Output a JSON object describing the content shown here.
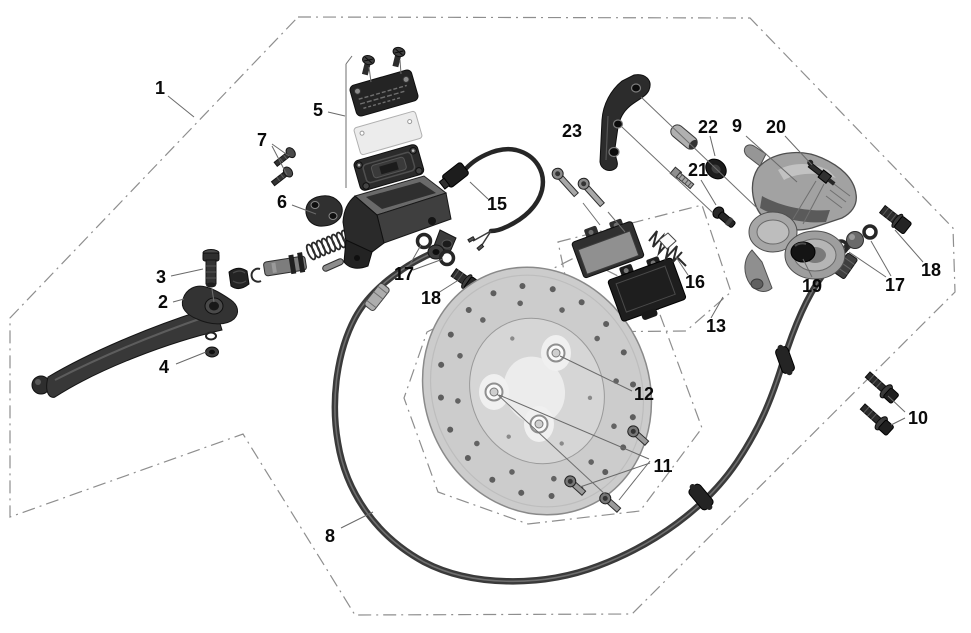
{
  "page": {
    "width": 971,
    "height": 633,
    "background": "#ffffff"
  },
  "diagram": {
    "type": "exploded-parts-diagram",
    "subject": "hydraulic-disc-brake-assembly",
    "colors": {
      "boundary_line": "#8e8e8e",
      "leader_line": "#6a6a6a",
      "label_text": "#0a0a0a",
      "dark_part": "#2b2b2b",
      "light_part": "#c9c9c9",
      "caliper_gray": "#9e9e9e",
      "disc_gray": "#cccccc",
      "background": "#ffffff"
    },
    "boundaries": [
      {
        "name": "outer-region",
        "points": [
          [
            298,
            17
          ],
          [
            750,
            18
          ],
          [
            953,
            228
          ],
          [
            955,
            292
          ],
          [
            632,
            614
          ],
          [
            355,
            615
          ],
          [
            243,
            434
          ],
          [
            10,
            517
          ],
          [
            10,
            318
          ]
        ]
      },
      {
        "name": "disc-region",
        "points": [
          [
            427,
            332
          ],
          [
            578,
            256
          ],
          [
            652,
            293
          ],
          [
            702,
            428
          ],
          [
            640,
            511
          ],
          [
            528,
            524
          ],
          [
            438,
            492
          ],
          [
            404,
            398
          ]
        ]
      },
      {
        "name": "pads-region",
        "points": [
          [
            558,
            242
          ],
          [
            702,
            205
          ],
          [
            731,
            292
          ],
          [
            686,
            331
          ],
          [
            577,
            332
          ]
        ]
      }
    ],
    "assembly_lines": [
      [
        352,
        56,
        346,
        64
      ],
      [
        346,
        64,
        346,
        188
      ],
      [
        369,
        67,
        371,
        82
      ],
      [
        400,
        60,
        401,
        74
      ],
      [
        212,
        289,
        214,
        302
      ],
      [
        641,
        97,
        757,
        208
      ],
      [
        622,
        127,
        713,
        213
      ],
      [
        583,
        203,
        600,
        225
      ],
      [
        608,
        212,
        625,
        232
      ],
      [
        816,
        181,
        793,
        219
      ],
      [
        824,
        184,
        803,
        224
      ],
      [
        497,
        394,
        607,
        496
      ]
    ],
    "callouts": [
      {
        "id": "1",
        "text": "1",
        "x": 160,
        "y": 88,
        "leaders": [
          [
            168,
            96,
            194,
            117
          ]
        ]
      },
      {
        "id": "2",
        "text": "2",
        "x": 163,
        "y": 302,
        "leaders": [
          [
            173,
            302,
            184,
            299
          ]
        ]
      },
      {
        "id": "3",
        "text": "3",
        "x": 161,
        "y": 277,
        "leaders": [
          [
            171,
            276,
            203,
            269
          ]
        ]
      },
      {
        "id": "4",
        "text": "4",
        "x": 164,
        "y": 367,
        "leaders": [
          [
            176,
            364,
            206,
            352
          ]
        ]
      },
      {
        "id": "5",
        "text": "5",
        "x": 318,
        "y": 110,
        "leaders": [
          [
            328,
            112,
            345,
            116
          ]
        ]
      },
      {
        "id": "6",
        "text": "6",
        "x": 282,
        "y": 202,
        "leaders": [
          [
            292,
            205,
            316,
            214
          ]
        ]
      },
      {
        "id": "7",
        "text": "7",
        "x": 262,
        "y": 140,
        "leaders": [
          [
            272,
            144,
            289,
            156
          ],
          [
            272,
            146,
            287,
            175
          ]
        ]
      },
      {
        "id": "8",
        "text": "8",
        "x": 330,
        "y": 536,
        "leaders": [
          [
            341,
            528,
            373,
            512
          ]
        ]
      },
      {
        "id": "9",
        "text": "9",
        "x": 737,
        "y": 126,
        "leaders": [
          [
            746,
            136,
            797,
            182
          ]
        ]
      },
      {
        "id": "10",
        "text": "10",
        "x": 918,
        "y": 418,
        "leaders": [
          [
            905,
            412,
            888,
            396
          ],
          [
            905,
            418,
            891,
            425
          ]
        ]
      },
      {
        "id": "11",
        "text": "11",
        "x": 663,
        "y": 466,
        "leaders": [
          [
            650,
            461,
            619,
            500
          ],
          [
            650,
            463,
            580,
            487
          ],
          [
            649,
            459,
            499,
            395
          ]
        ]
      },
      {
        "id": "12",
        "text": "12",
        "x": 644,
        "y": 394,
        "leaders": [
          [
            632,
            391,
            560,
            356
          ]
        ]
      },
      {
        "id": "13",
        "text": "13",
        "x": 716,
        "y": 326,
        "leaders": [
          [
            711,
            318,
            723,
            297
          ]
        ]
      },
      {
        "id": "15",
        "text": "15",
        "x": 497,
        "y": 204,
        "leaders": [
          [
            488,
            199,
            470,
            182
          ]
        ]
      },
      {
        "id": "16",
        "text": "16",
        "x": 695,
        "y": 282,
        "leaders": [
          [
            688,
            275,
            676,
            257
          ]
        ]
      },
      {
        "id": "17a",
        "text": "17",
        "x": 404,
        "y": 274,
        "leaders": [
          [
            409,
            266,
            421,
            245
          ],
          [
            413,
            270,
            443,
            259
          ]
        ]
      },
      {
        "id": "18a",
        "text": "18",
        "x": 431,
        "y": 298,
        "leaders": [
          [
            438,
            293,
            457,
            281
          ]
        ]
      },
      {
        "id": "17b",
        "text": "17",
        "x": 895,
        "y": 285,
        "leaders": [
          [
            886,
            277,
            849,
            252
          ],
          [
            891,
            276,
            871,
            241
          ]
        ]
      },
      {
        "id": "18b",
        "text": "18",
        "x": 931,
        "y": 270,
        "leaders": [
          [
            923,
            262,
            895,
            230
          ]
        ]
      },
      {
        "id": "19",
        "text": "19",
        "x": 812,
        "y": 286,
        "leaders": [
          [
            812,
            277,
            803,
            259
          ]
        ]
      },
      {
        "id": "20",
        "text": "20",
        "x": 776,
        "y": 127,
        "leaders": [
          [
            785,
            136,
            812,
            165
          ]
        ]
      },
      {
        "id": "21",
        "text": "21",
        "x": 698,
        "y": 170,
        "leaders": [
          [
            701,
            180,
            716,
            205
          ]
        ]
      },
      {
        "id": "22",
        "text": "22",
        "x": 708,
        "y": 127,
        "leaders": [
          [
            710,
            136,
            715,
            156
          ]
        ]
      },
      {
        "id": "23",
        "text": "23",
        "x": 572,
        "y": 131,
        "leaders": []
      }
    ]
  }
}
